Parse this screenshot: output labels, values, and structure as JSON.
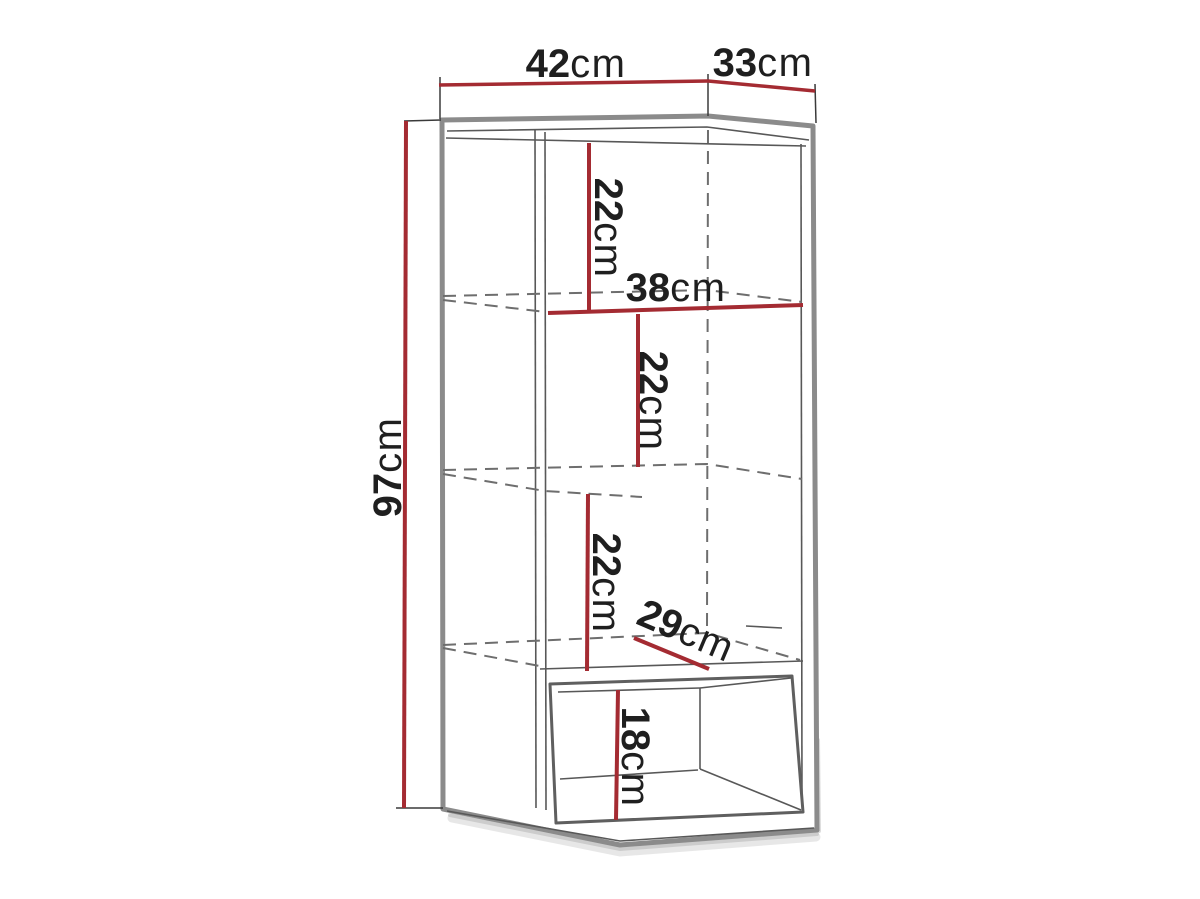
{
  "diagram": {
    "type": "furniture-dimension-drawing",
    "overall": {
      "width": {
        "value": "42",
        "unit": "cm"
      },
      "depth": {
        "value": "33",
        "unit": "cm"
      },
      "height": {
        "value": "97",
        "unit": "cm"
      }
    },
    "interior": {
      "shelf_spacings": [
        {
          "value": "22",
          "unit": "cm"
        },
        {
          "value": "22",
          "unit": "cm"
        },
        {
          "value": "22",
          "unit": "cm"
        }
      ],
      "shelf_width": {
        "value": "38",
        "unit": "cm"
      },
      "shelf_depth": {
        "value": "29",
        "unit": "cm"
      },
      "open_niche_height": {
        "value": "18",
        "unit": "cm"
      }
    },
    "colors": {
      "dimension_line": "#a42b32",
      "outline": "#8b8b8b",
      "hidden_line": "#6e6e6e",
      "text": "#1f1f1f",
      "background": "#ffffff"
    }
  }
}
